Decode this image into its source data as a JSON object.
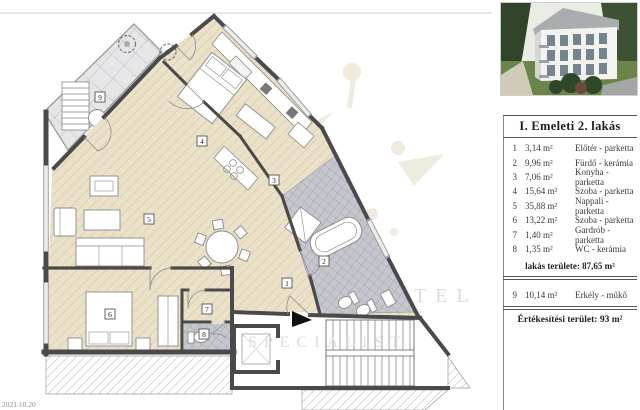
{
  "window": {
    "date_stamp": "2021.10.20"
  },
  "watermark": {
    "line1": "TEL",
    "line2": "SPECIALIST"
  },
  "plan": {
    "tags": [
      "1",
      "2",
      "3",
      "4",
      "5",
      "6",
      "7",
      "8",
      "9"
    ]
  },
  "panel": {
    "title": "I. Emeleti 2. lakás",
    "rows": [
      {
        "num": "1",
        "area": "3,14 m²",
        "name": "Előtér - parketta"
      },
      {
        "num": "2",
        "area": "9,96 m²",
        "name": "Fürdő - kerámia"
      },
      {
        "num": "3",
        "area": "7,06 m²",
        "name": "Konyha - parketta"
      },
      {
        "num": "4",
        "area": "15,64 m²",
        "name": "Szoba - parketta"
      },
      {
        "num": "5",
        "area": "35,88 m²",
        "name": "Nappali - parketta"
      },
      {
        "num": "6",
        "area": "13,22 m²",
        "name": "Szoba - parketta"
      },
      {
        "num": "7",
        "area": "1,40 m²",
        "name": "Gardrób - parketta"
      },
      {
        "num": "8",
        "area": "1,35 m²",
        "name": "WC - kerámia"
      }
    ],
    "subtotal": "lakás területe: 87,65 m²",
    "balcony_row": {
      "num": "9",
      "area": "10,14 m²",
      "name": "Erkély - műkő"
    },
    "total": "Értékesítési terület:  93 m²"
  },
  "colors": {
    "wall": "#4a4a4a",
    "parquet": "#eae1c8",
    "terrace_tile": "#e6e6e8",
    "bath_tile": "#c6c7ce",
    "ornament": "#d4c3a0"
  }
}
